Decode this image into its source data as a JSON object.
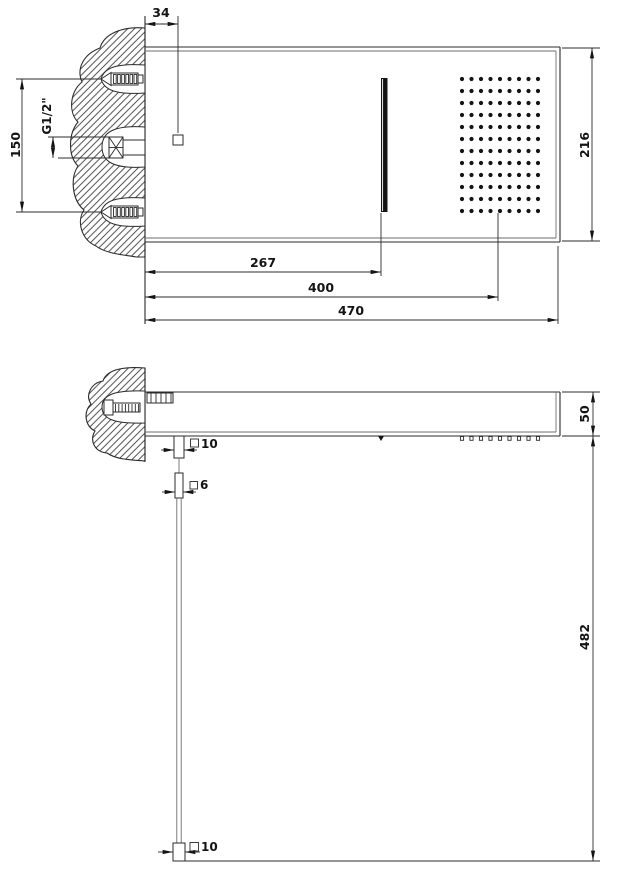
{
  "top_view": {
    "dim_wall_offset": "34",
    "dim_fixing_span": "150",
    "dim_thread": "G1/2\"",
    "dim_plate_depth": "216",
    "dim_slot_distance": "267",
    "dim_spray_distance": "400",
    "dim_plate_length": "470",
    "spray_grid": {
      "cols": 9,
      "rows": 12
    }
  },
  "side_view": {
    "dim_plate_thickness": "50",
    "dim_drop_height": "482",
    "dim_jet_section_top": "10",
    "dim_jet_section_mid": "6",
    "dim_jet_section_bottom": "10",
    "nozzle_stub_count": 9
  }
}
